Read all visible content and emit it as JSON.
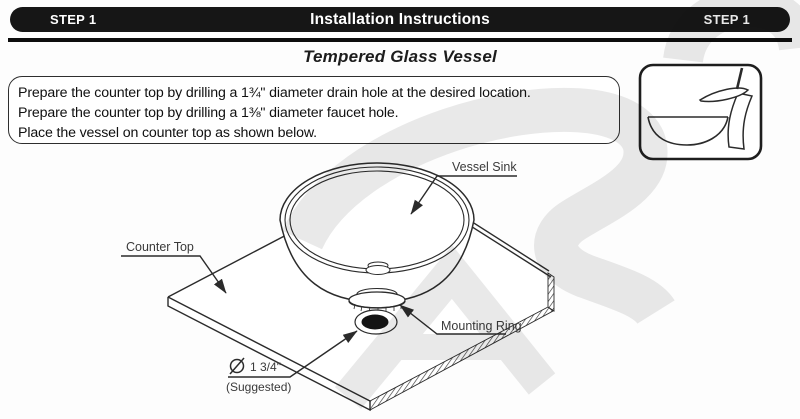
{
  "header": {
    "left_badge": "STEP 1",
    "title": "Installation Instructions",
    "right_badge": "STEP 1"
  },
  "page": {
    "section_title": "Tempered Glass Vessel"
  },
  "instructions": {
    "lines": [
      "Prepare the counter top by drilling a 1¾\" diameter drain hole at the desired location.",
      "Prepare the counter top by drilling a 1⅜\" diameter faucet hole.",
      "Place the vessel on counter top as shown below."
    ]
  },
  "diagram": {
    "labels": {
      "vessel_sink": "Vessel Sink",
      "counter_top": "Counter Top",
      "mounting_ring": "Mounting Ring",
      "drain_hole_diameter": "1 3/4\"",
      "drain_hole_note": "(Suggested)"
    }
  },
  "colors": {
    "header_bg": "#161616",
    "header_text": "#ffffff",
    "line_color": "#2b2b2b",
    "label_color": "#3a3a3a",
    "watermark": "#e7e7e7"
  }
}
